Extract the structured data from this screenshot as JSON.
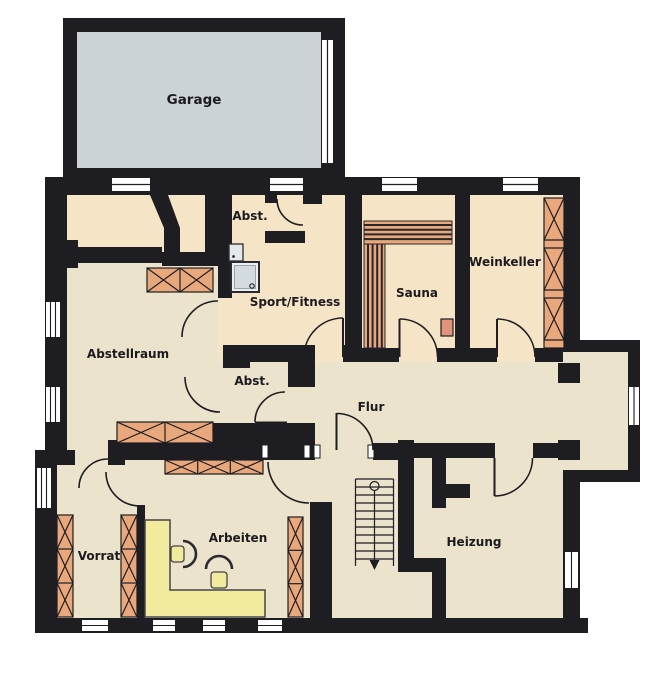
{
  "plan": {
    "title": "Basement floor plan",
    "rooms": {
      "garage": "Garage",
      "abst_top": "Abst.",
      "sport_fitness": "Sport/Fitness",
      "sauna": "Sauna",
      "weinkeller": "Weinkeller",
      "abstellraum": "Abstellraum",
      "abst_mid": "Abst.",
      "flur": "Flur",
      "vorrat": "Vorrat",
      "arbeiten": "Arbeiten",
      "heizung": "Heizung"
    },
    "colors": {
      "wall": "#1d1d22",
      "floor_main": "#ece3cd",
      "floor_warm": "#f5e5c6",
      "floor_garage": "#ccd3d7",
      "furniture_orange": "#e9a77c",
      "desk_yellow": "#f2eb9d",
      "shower_blue": "#d3dce1",
      "shower_frame": "#eceff1",
      "heater_orange": "#e2937b",
      "window_white": "#ffffff"
    }
  }
}
